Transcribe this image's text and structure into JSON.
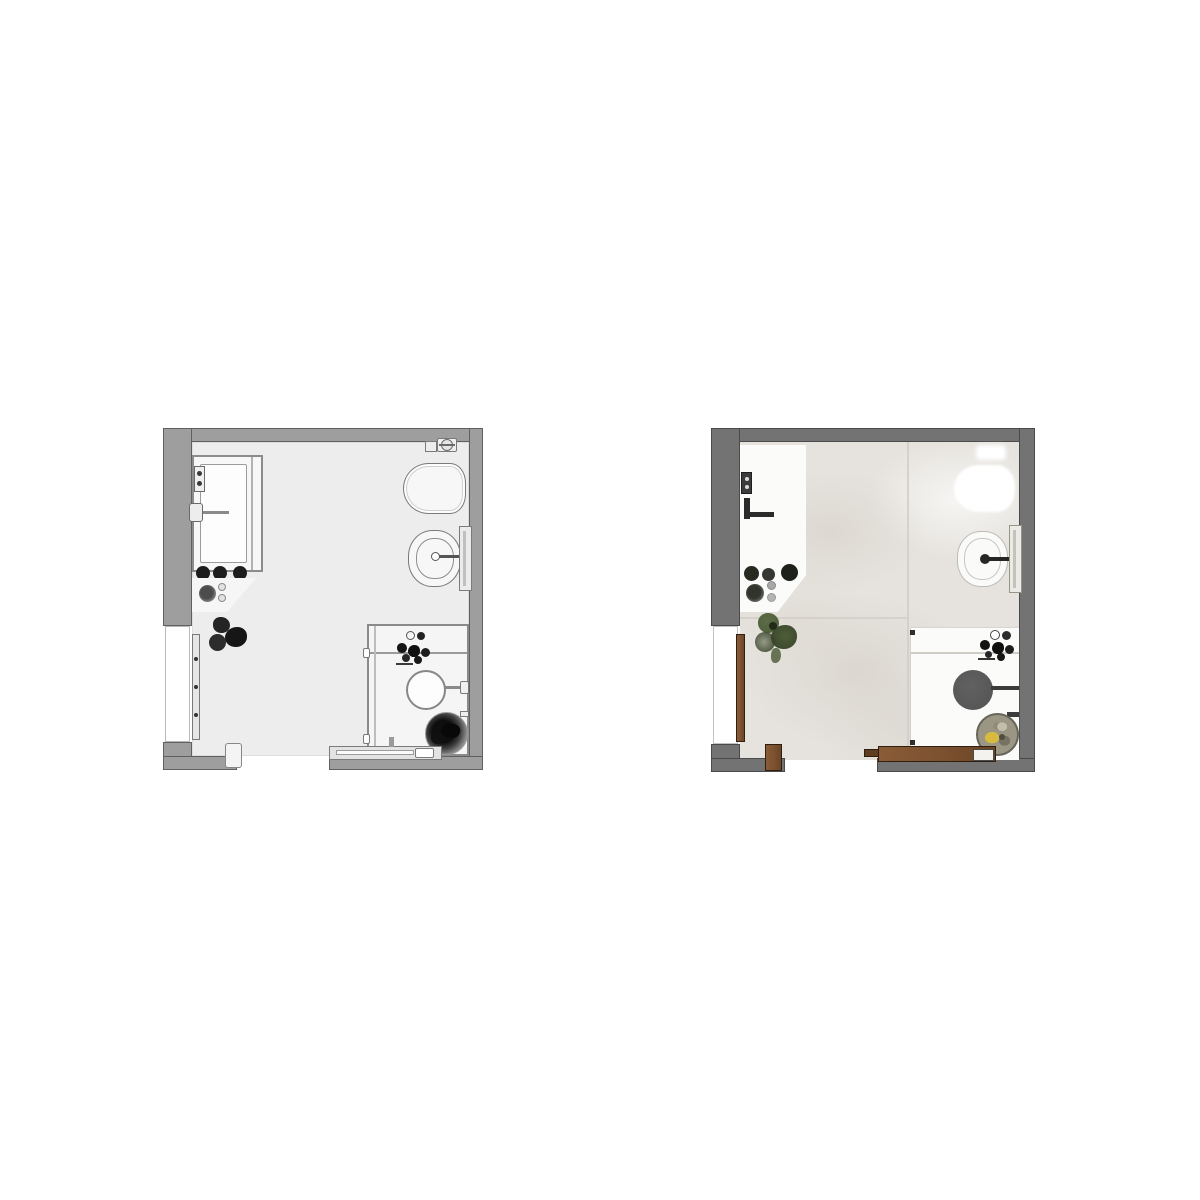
{
  "page": {
    "background": "#ffffff",
    "description": "side-by-side bathroom floor plans"
  },
  "plans": {
    "left": {
      "name": "schematic-floor-plan",
      "title": "Bathroom floor plan — schematic line drawing",
      "style": "grayscale line drawing",
      "colors": {
        "wall": "#9e9e9e",
        "wallBorder": "#606060",
        "floor": "#ededed",
        "line": "#7a7a7a",
        "fixture": "#f7f7f7",
        "dark": "#1c1c1c",
        "wood": "#e3e3e3",
        "woodBorder": "#7a7a7a"
      },
      "fixtures": [
        "bathtub",
        "tub-faucet",
        "wall-control",
        "counter",
        "counter-bowls",
        "knobs",
        "plant",
        "toilet",
        "cistern",
        "bidet",
        "bidet-faucet",
        "wall-bracket",
        "shower-enclosure",
        "shower-accessories",
        "shower-seat",
        "dark-planter",
        "sliding-door-track",
        "entry-door",
        "door-jamb"
      ]
    },
    "right": {
      "name": "rendered-floor-plan",
      "title": "Bathroom floor plan — textured render",
      "style": "textured color render",
      "colors": {
        "wall": "#737373",
        "wallBorder": "#4a4a4a",
        "floor": "#e6e3de",
        "line": "#9a968e",
        "fixture": "#fbfbfa",
        "dark": "#222222",
        "seam": "#cfccc5",
        "wood": "#7b5130",
        "woodBorder": "#2e1f10",
        "plant": "#4e5d39",
        "plantDark": "#36422a",
        "stool": "#575757",
        "potBase": "#9b9684",
        "potYellow": "#d8ba3e"
      },
      "fixtures": [
        "vanity-counter",
        "vanity-faucet",
        "wall-control",
        "counter-bowls",
        "knobs",
        "plant",
        "toilet",
        "bidet",
        "bidet-faucet",
        "wall-bracket",
        "shower-floor",
        "shower-accessories",
        "shower-stool",
        "plant-pot",
        "wood-sliding-door-track",
        "wood-entry-door",
        "wood-door-jamb"
      ]
    }
  }
}
